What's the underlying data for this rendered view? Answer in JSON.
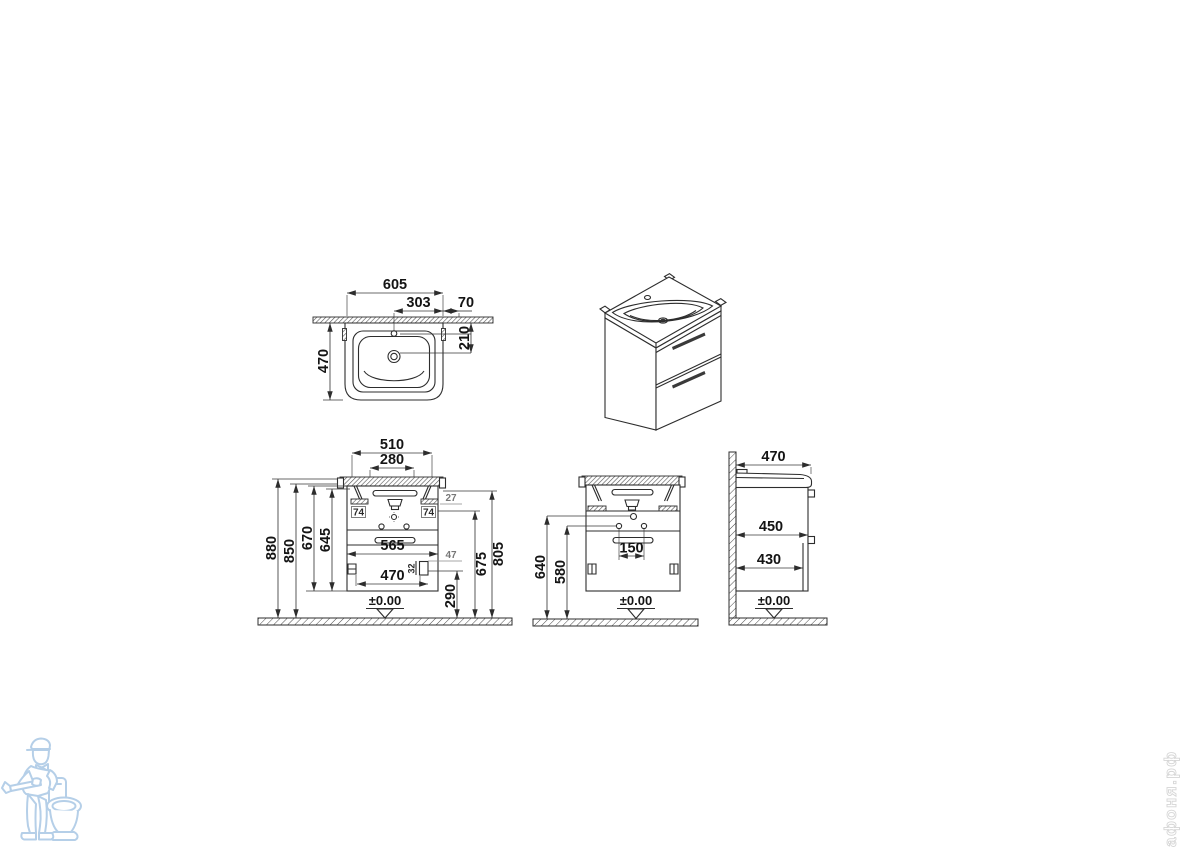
{
  "datum_label": "±0.00",
  "top_view": {
    "width": "605",
    "center_to_edge": "303",
    "edge_offset": "70",
    "depth": "470",
    "wall_to_drain": "210"
  },
  "front_view": {
    "width_510": "510",
    "width_280": "280",
    "width_565": "565",
    "width_470": "470",
    "height_880": "880",
    "height_850": "850",
    "height_670": "670",
    "height_645": "645",
    "height_805": "805",
    "height_675": "675",
    "height_290": "290",
    "offset_27": "27",
    "offset_47": "47",
    "offset_32": "32",
    "bracket_74_left": "74",
    "bracket_74_right": "74"
  },
  "rear_view": {
    "height_640": "640",
    "height_580": "580",
    "spacing_150": "150"
  },
  "side_view": {
    "depth_470": "470",
    "depth_450": "450",
    "depth_430": "430"
  },
  "watermark": {
    "site_text": "афоня.рф"
  }
}
